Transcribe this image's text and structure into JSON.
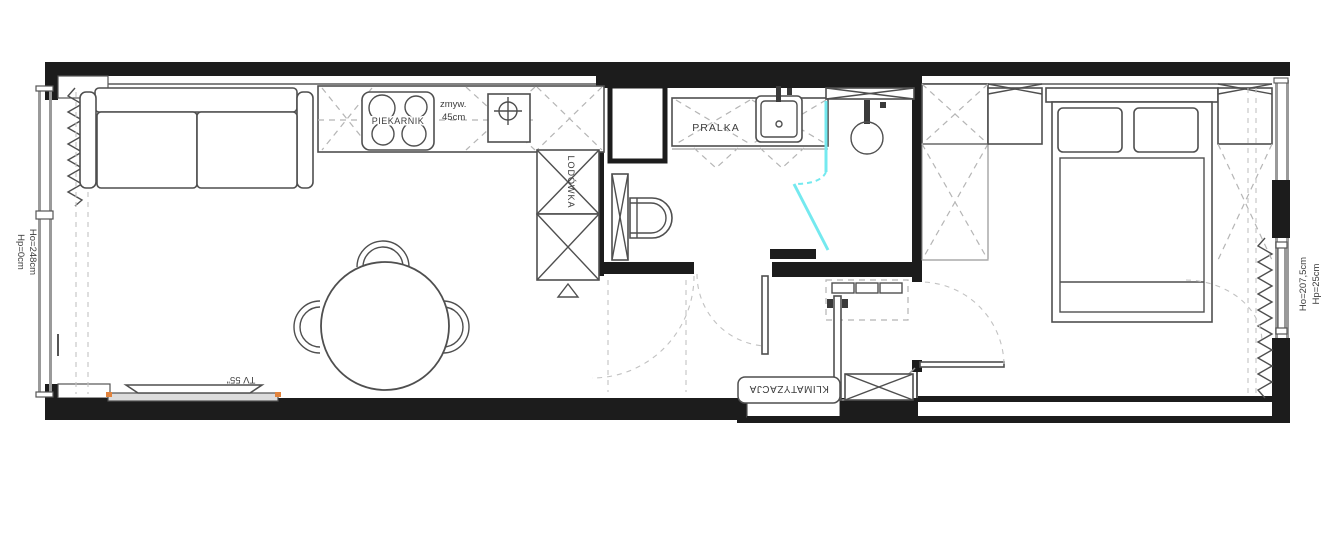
{
  "plan_title": "apartment floor plan",
  "labels": {
    "oven": "PIEKARNIK",
    "dishwasher_line1": "zmyw.",
    "dishwasher_line2": "45cm",
    "fridge": "LODÓWKA",
    "washing_machine": "PRALKA",
    "air_conditioning": "KLIMATYZACJA",
    "tv": "TV 55\"",
    "window_left_height": "Ho=248cm",
    "window_left_sill": "Hp=0cm",
    "window_right_height": "Ho=207,5cm",
    "window_right_sill": "Hp=25cm"
  },
  "colors": {
    "wall": "#1c1c1c",
    "furniture_line": "#4f4f4f",
    "dashed_line": "#b5b5b5",
    "shower_glass": "#74e9ef",
    "accent_orange": "#e2833c",
    "background": "#ffffff",
    "text": "#3c3c3c"
  }
}
